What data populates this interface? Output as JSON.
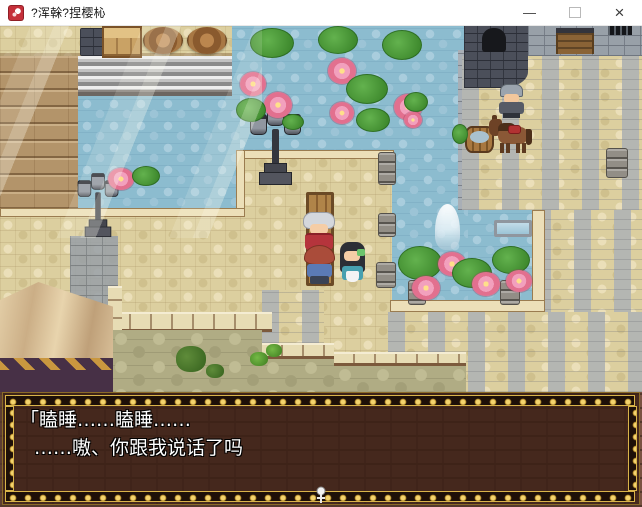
{
  "window": {
    "title": "?浑榦?捏樱杺",
    "controls": {
      "minimize_label": "—",
      "close_label": "×"
    }
  },
  "game": {
    "dialogue": {
      "line1": "「瞌睡……瞌睡……",
      "line2": "……嗷、你跟我说话了吗"
    },
    "scene_entities": [
      "water-pool-with-lily-pads-and-lotus-flowers",
      "stone-plaza",
      "gray-castle-courtyard",
      "castle-tower",
      "castle-wall-with-wooden-gate",
      "stone-stairs",
      "wooden-deck",
      "two-street-lamps",
      "wooden-bench",
      "old-woman-npc-in-red",
      "red-haired-child-npc",
      "black-haired-maid-npc",
      "soldier-npc",
      "brown-horse-with-red-saddle",
      "white-ghost",
      "wooden-bucket",
      "two-barrels",
      "wooden-crate",
      "stone-pillar-stacks",
      "beige-tent",
      "green-cobblestone-road",
      "small-plants",
      "sunbeam-light-rays"
    ]
  },
  "icons": {
    "app-icon": "red dragon crest on white (game engine icon)",
    "minimize-icon": "—",
    "maximize-icon": "□ (outline square)",
    "close-icon": "×",
    "pause-cursor": "small white ornament at dialogue bottom center"
  },
  "palette": {
    "titlebar-bg": "#ffffff",
    "titlebar-text": "#1a1a1a",
    "app-red": "#c5303a",
    "water": "#8cbccf",
    "stone-beige": "#dccf9f",
    "courtyard-gray": "#b4b6b2",
    "castle-gray": "#98a0a8",
    "tower-dark": "#4b4f5a",
    "wood": "#b3946a",
    "tent-canvas": "#d8c19b",
    "road-green": "#b0ac84",
    "dialogue-bg": "rgba(56,30,20,0.8)",
    "dialogue-gold": "#d9b44a",
    "dialogue-text": "#ffffff"
  }
}
